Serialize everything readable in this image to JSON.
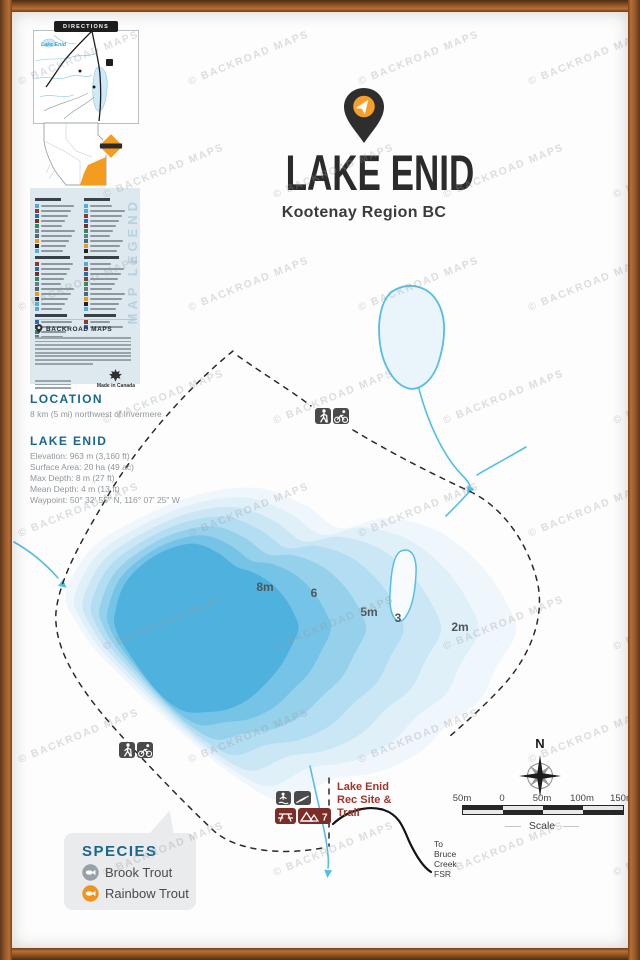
{
  "brand": {
    "watermark": "© BACKROAD MAPS"
  },
  "header": {
    "title": "LAKE ENID",
    "subtitle": "Kootenay Region BC",
    "logo": "map-pin-logo"
  },
  "inset": {
    "directions_title": "DIRECTIONS",
    "inset_lake_label": "Lake Enid"
  },
  "legend": {
    "title": "MAP LEGEND",
    "footer_title": "BACKROAD MAPS",
    "made_in": "Made in Canada"
  },
  "location": {
    "heading": "LOCATION",
    "text": "8 km (5 mi) northwest of Invermere"
  },
  "lake_info": {
    "heading": "LAKE ENID",
    "lines": [
      "Elevation: 963 m (3,160 ft)",
      "Surface Area: 20 ha (49 ac)",
      "Max Depth: 8 m (27 ft)",
      "Mean Depth: 4 m (13 ft)",
      "Waypoint: 50° 32' 55\" N, 116° 07' 25\" W"
    ]
  },
  "lake": {
    "depth_labels": [
      "8m",
      "6",
      "5m",
      "3",
      "2m"
    ],
    "depth_colors": [
      "#F0F7FC",
      "#E0F0F9",
      "#CBE7F6",
      "#B2DDF2",
      "#96D1EC",
      "#75C3E6",
      "#4FB2DE"
    ]
  },
  "map": {
    "rec_site_lines": [
      "Lake Enid",
      "Rec Site &",
      "Trail"
    ],
    "road_label_lines": [
      "To",
      "Bruce",
      "Creek",
      "FSR"
    ],
    "camp_count": "7",
    "compass_n": "N"
  },
  "scalebar": {
    "labels": [
      "50m",
      "0",
      "50m",
      "100m",
      "150m"
    ],
    "caption": "Scale"
  },
  "species": {
    "title": "SPECIES",
    "items": [
      {
        "name": "Brook Trout",
        "color": "#97A1A7"
      },
      {
        "name": "Rainbow Trout",
        "color": "#F0941F"
      }
    ]
  },
  "colors": {
    "accent_orange": "#F5A02A",
    "heading_blue": "#19678D",
    "water_line": "#54BEE4",
    "deep_water": "#4FB2DE",
    "rec_red": "#A1362C",
    "icon_gray": "#4A4A4A",
    "icon_maroon": "#7B2D26",
    "frame_brown": "#96572A"
  }
}
